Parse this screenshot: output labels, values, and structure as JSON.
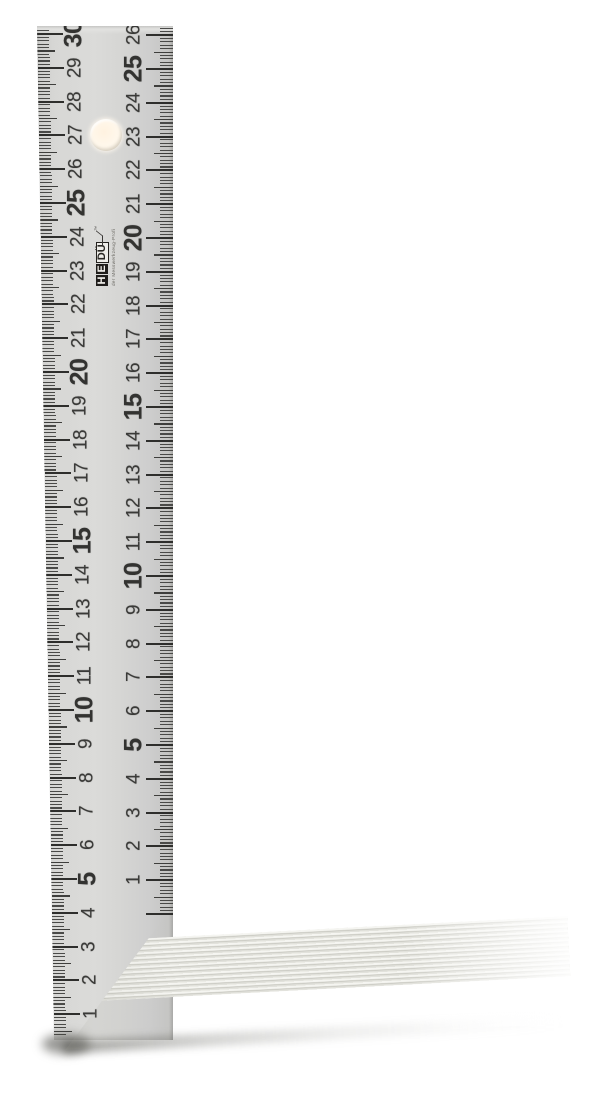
{
  "logo": {
    "text_h": "H",
    "text_e": "E",
    "text_du": "DÜ",
    "trademark": "™",
    "tagline": "der Messwerkzeug-Profi"
  },
  "blade": {
    "unit": "cm",
    "left_scale": {
      "numbers": [
        1,
        2,
        3,
        4,
        5,
        6,
        7,
        8,
        9,
        10,
        11,
        12,
        13,
        14,
        15,
        16,
        17,
        18,
        19,
        20,
        21,
        22,
        23,
        24,
        25,
        26,
        27,
        28,
        29,
        30
      ],
      "emphasized_every": 5,
      "reading_direction": "bottom-to-top"
    },
    "right_scale": {
      "numbers": [
        1,
        2,
        3,
        4,
        5,
        6,
        7,
        8,
        9,
        10,
        11,
        12,
        13,
        14,
        15,
        16,
        17,
        18,
        19,
        20,
        21,
        22,
        23,
        24,
        25,
        26
      ],
      "emphasized_every": 5,
      "reading_direction": "bottom-to-top"
    }
  },
  "colors": {
    "background": "#ffffff",
    "blade_face": "#d7d7d5",
    "tick": "#3e3e3c",
    "number": "#3a3a38",
    "stock_face": "#e7e7e1",
    "stock_rib_line": "#c6c6be",
    "hole_light": "#fff2e0",
    "logo_black": "#1f1d1b"
  }
}
